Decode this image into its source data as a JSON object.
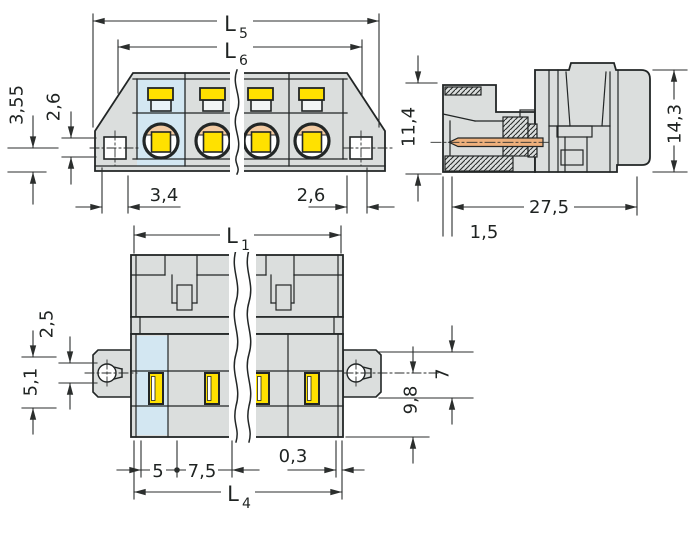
{
  "drawing": {
    "type": "technical-dimension-drawing",
    "views": {
      "front": {
        "dims": {
          "overall_width": {
            "base": "L",
            "sub": "5"
          },
          "body_width": {
            "base": "L",
            "sub": "6"
          },
          "flange_hole_to_bottom": "3,55",
          "flange_hole_height": "2,6",
          "left_hole_offset": "3,4",
          "right_hole_offset": "2,6"
        }
      },
      "side": {
        "dims": {
          "front_height": "11,4",
          "overall_height": "14,3",
          "overall_depth": "27,5",
          "wall_thickness": "1,5"
        }
      },
      "bottom": {
        "dims": {
          "overall_length": {
            "base": "L",
            "sub": "1"
          },
          "pin_row_length": {
            "base": "L",
            "sub": "4"
          },
          "flange_slot_height": "2,5",
          "flange_plate_height": "5,1",
          "flange_width": "7",
          "body_depth": "9,8",
          "first_pin_offset": "5",
          "pin_pitch": "7,5",
          "edge_gap": "0,3"
        }
      }
    },
    "colors": {
      "body_gray": "#dbdedd",
      "highlight_blue": "#d3e7f2",
      "contact_yellow": "#ffe100",
      "clamp_peach": "#f3cba3",
      "pin_copper": "#eeb07c",
      "outline": "#222626",
      "dimension_line": "#2b2e2d",
      "background": "#ffffff"
    }
  }
}
